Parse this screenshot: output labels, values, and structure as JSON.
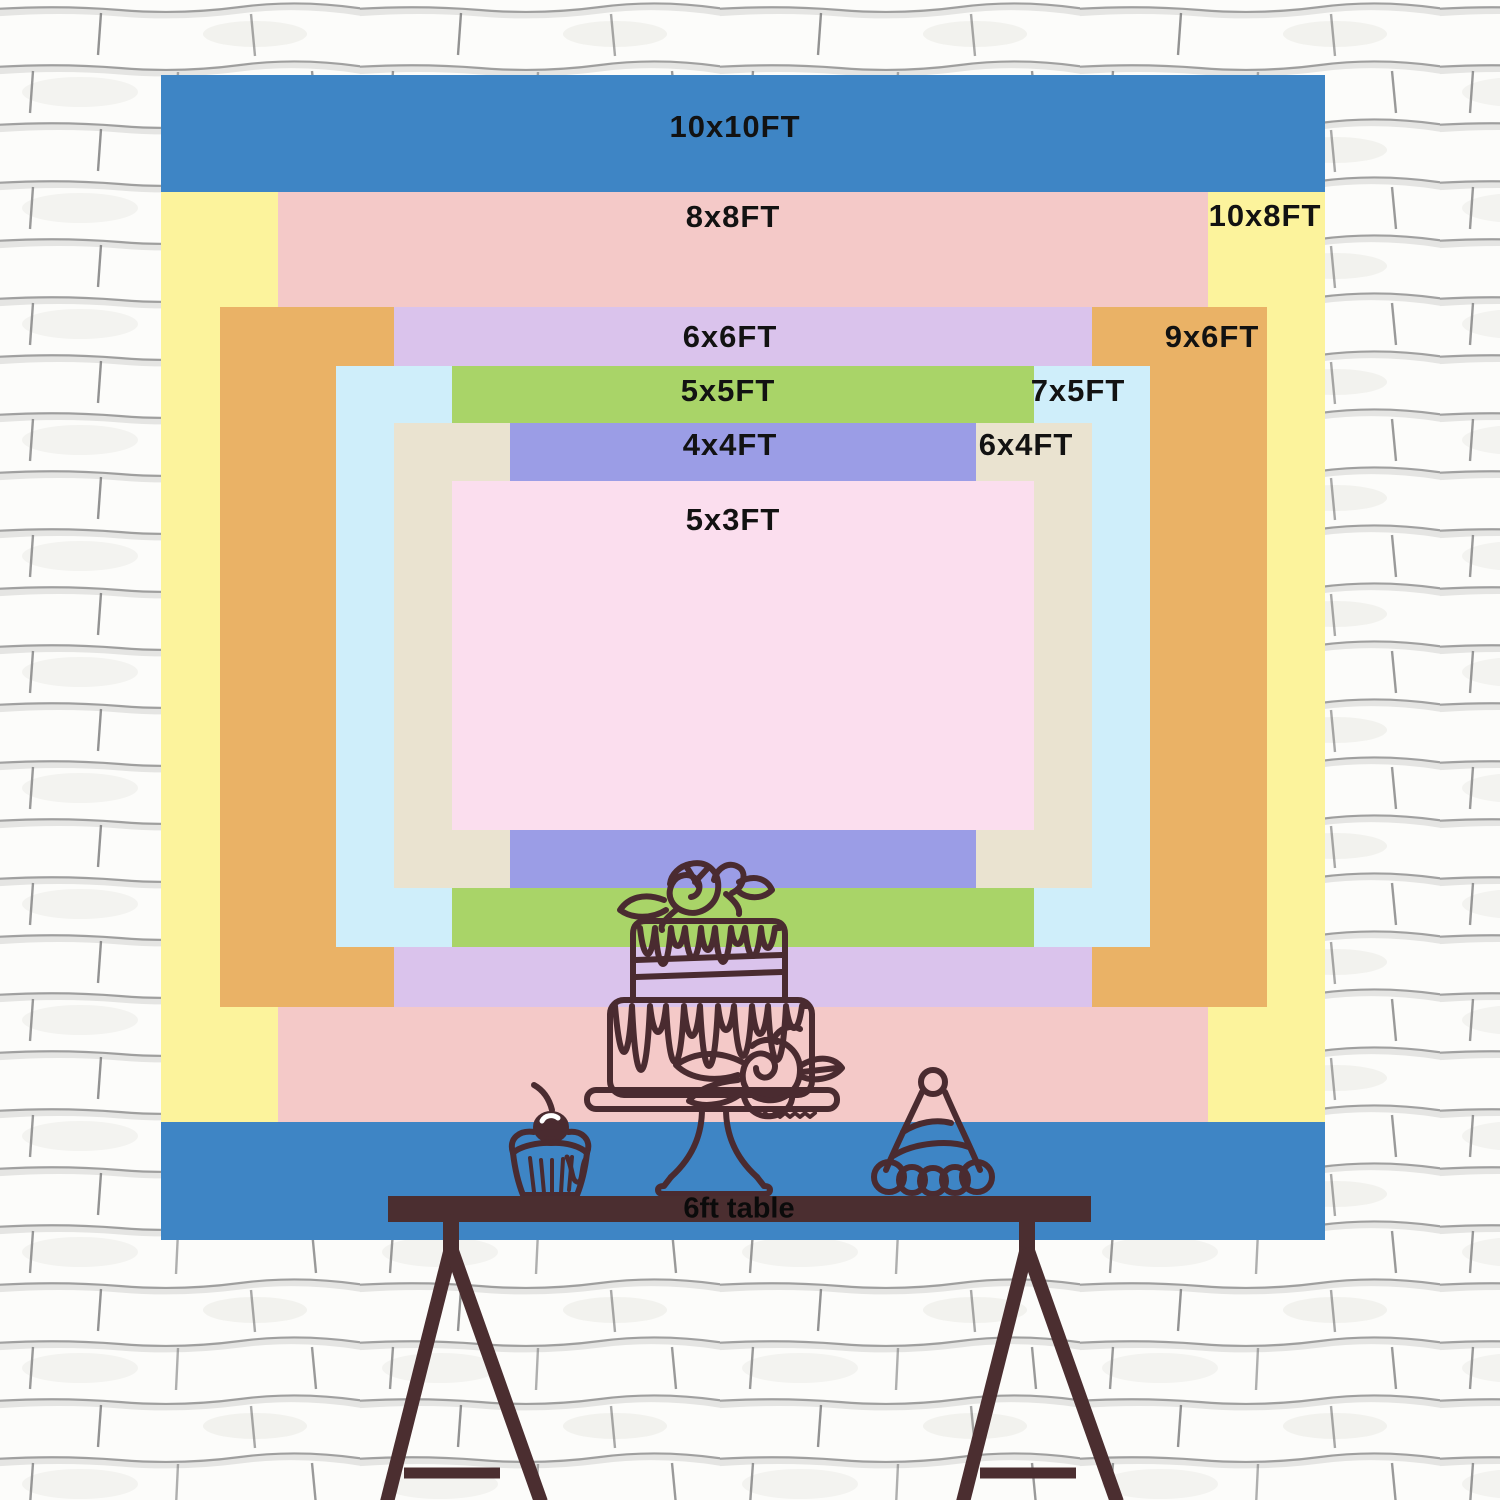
{
  "chart_data": {
    "type": "nested-rectangles-size-chart",
    "title": "Backdrop size comparison chart",
    "unit": "FT",
    "sizes": [
      {
        "label": "10x10FT",
        "width_ft": 10,
        "height_ft": 10,
        "color": "#3e85c5",
        "rect": {
          "x": 161,
          "y": 75,
          "w": 1164,
          "h": 1165
        },
        "label_pos": {
          "x": 735,
          "y": 127
        }
      },
      {
        "label": "10x8FT",
        "width_ft": 10,
        "height_ft": 8,
        "color": "#fcf39c",
        "rect": {
          "x": 161,
          "y": 192,
          "w": 1164,
          "h": 930
        },
        "label_pos": {
          "x": 1265,
          "y": 216
        }
      },
      {
        "label": "8x8FT",
        "width_ft": 8,
        "height_ft": 8,
        "color": "#f4c9c8",
        "rect": {
          "x": 278,
          "y": 192,
          "w": 930,
          "h": 930
        },
        "label_pos": {
          "x": 733,
          "y": 217
        }
      },
      {
        "label": "9x6FT",
        "width_ft": 9,
        "height_ft": 6,
        "color": "#eab266",
        "rect": {
          "x": 220,
          "y": 307,
          "w": 1047,
          "h": 700
        },
        "label_pos": {
          "x": 1212,
          "y": 337
        }
      },
      {
        "label": "6x6FT",
        "width_ft": 6,
        "height_ft": 6,
        "color": "#dac3ec",
        "rect": {
          "x": 394,
          "y": 307,
          "w": 698,
          "h": 700
        },
        "label_pos": {
          "x": 730,
          "y": 337
        }
      },
      {
        "label": "7x5FT",
        "width_ft": 7,
        "height_ft": 5,
        "color": "#cfeefa",
        "rect": {
          "x": 336,
          "y": 366,
          "w": 814,
          "h": 581
        },
        "label_pos": {
          "x": 1078,
          "y": 391
        }
      },
      {
        "label": "5x5FT",
        "width_ft": 5,
        "height_ft": 5,
        "color": "#a9d468",
        "rect": {
          "x": 452,
          "y": 366,
          "w": 582,
          "h": 581
        },
        "label_pos": {
          "x": 728,
          "y": 391
        }
      },
      {
        "label": "6x4FT",
        "width_ft": 6,
        "height_ft": 4,
        "color": "#eae3d0",
        "rect": {
          "x": 394,
          "y": 423,
          "w": 698,
          "h": 465
        },
        "label_pos": {
          "x": 1026,
          "y": 445
        }
      },
      {
        "label": "4x4FT",
        "width_ft": 4,
        "height_ft": 4,
        "color": "#9b9de6",
        "rect": {
          "x": 510,
          "y": 423,
          "w": 466,
          "h": 465
        },
        "label_pos": {
          "x": 730,
          "y": 445
        }
      },
      {
        "label": "5x3FT",
        "width_ft": 5,
        "height_ft": 3,
        "color": "#fbdeee",
        "rect": {
          "x": 452,
          "y": 481,
          "w": 582,
          "h": 349
        },
        "label_pos": {
          "x": 733,
          "y": 520
        }
      }
    ]
  },
  "table": {
    "label": "6ft table"
  },
  "illustrations": {
    "items": [
      "two-tier-cake-on-stand",
      "cupcake-with-cherry",
      "party-hat",
      "trestle-table"
    ]
  },
  "colors": {
    "outline_brown": "#4a2b30",
    "table_brown": "#4b2e30",
    "label_text": "#121212",
    "wall_white": "#fbfbf9",
    "mortar_gray": "#8c8c8c"
  }
}
